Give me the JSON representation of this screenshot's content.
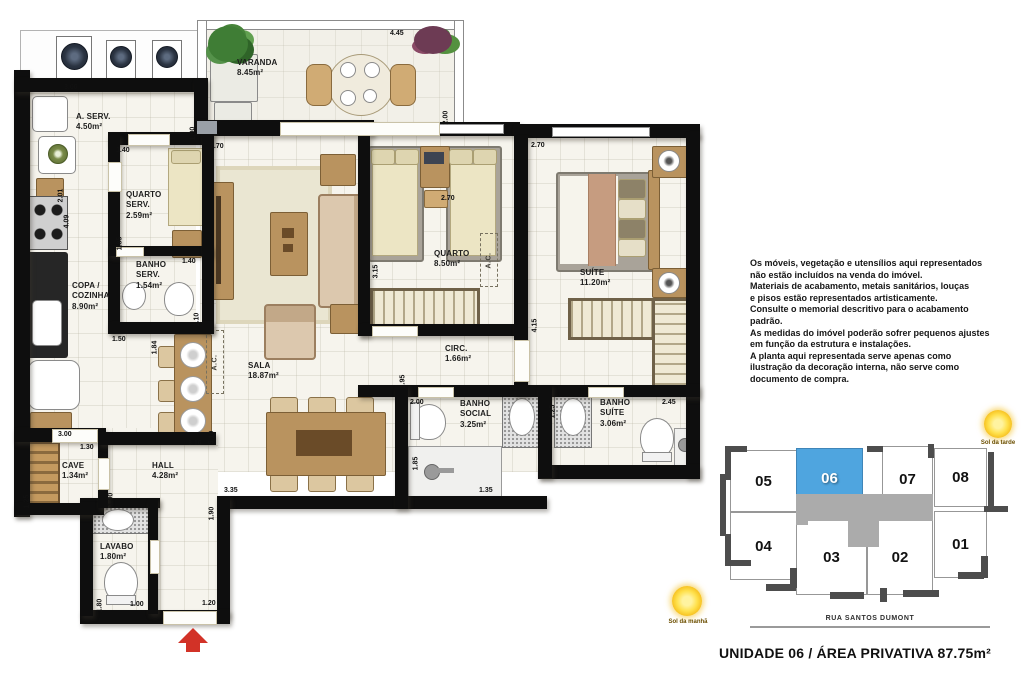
{
  "header": {
    "title": "UNIDADE 06 / ÁREA PRIVATIVA 87.75m²"
  },
  "disclaimer": {
    "lines": [
      "Os móveis, vegetação e utensílios aqui representados",
      "não estão incluídos na venda do imóvel.",
      "Materiais de acabamento, metais sanitários, louças",
      "e pisos estão representados artisticamente.",
      "Consulte o memorial descritivo para o acabamento",
      "padrão.",
      "As medidas do imóvel poderão sofrer pequenos ajustes",
      "em função da estrutura e instalações.",
      "A planta aqui representada serve apenas como",
      "ilustração da decoração interna, não serve como",
      "documento de compra."
    ]
  },
  "plan": {
    "ac_label": "A.C.",
    "rooms": [
      {
        "id": "varanda",
        "name": "VARANDA",
        "area": "8.45m²",
        "x": 237,
        "y": 58
      },
      {
        "id": "a-serv",
        "name": "A. SERV.",
        "area": "4.50m²",
        "x": 76,
        "y": 112
      },
      {
        "id": "quarto-serv",
        "name": "QUARTO\nSERV.",
        "area": "2.59m²",
        "x": 126,
        "y": 190
      },
      {
        "id": "banho-serv",
        "name": "BANHO\nSERV.",
        "area": "1.54m²",
        "x": 136,
        "y": 260
      },
      {
        "id": "copa-cozinha",
        "name": "COPA /\nCOZINHA",
        "area": "8.90m²",
        "x": 72,
        "y": 281
      },
      {
        "id": "sala",
        "name": "SALA",
        "area": "18.87m²",
        "x": 248,
        "y": 361
      },
      {
        "id": "quarto",
        "name": "QUARTO",
        "area": "8.50m²",
        "x": 434,
        "y": 249
      },
      {
        "id": "suite",
        "name": "SUÍTE",
        "area": "11.20m²",
        "x": 580,
        "y": 268
      },
      {
        "id": "circ",
        "name": "CIRC.",
        "area": "1.66m²",
        "x": 445,
        "y": 344
      },
      {
        "id": "banho-social",
        "name": "BANHO\nSOCIAL",
        "area": "3.25m²",
        "x": 460,
        "y": 399
      },
      {
        "id": "banho-suite",
        "name": "BANHO\nSUÍTE",
        "area": "3.06m²",
        "x": 600,
        "y": 398
      },
      {
        "id": "cave",
        "name": "CAVE",
        "area": "1.34m²",
        "x": 62,
        "y": 461
      },
      {
        "id": "hall",
        "name": "HALL",
        "area": "4.28m²",
        "x": 152,
        "y": 461
      },
      {
        "id": "lavabo",
        "name": "LAVABO",
        "area": "1.80m²",
        "x": 100,
        "y": 542
      }
    ],
    "dims": [
      {
        "t": "3.00",
        "x": 64,
        "y": 84
      },
      {
        "t": "1.00",
        "x": 188,
        "y": 120,
        "v": 1
      },
      {
        "t": "4.45",
        "x": 390,
        "y": 30
      },
      {
        "t": "2.00",
        "x": 441,
        "y": 104,
        "v": 1
      },
      {
        "t": "2.70",
        "x": 210,
        "y": 143
      },
      {
        "t": "1.40",
        "x": 116,
        "y": 147
      },
      {
        "t": "1.85",
        "x": 115,
        "y": 230,
        "v": 1
      },
      {
        "t": "2.01",
        "x": 56,
        "y": 182,
        "v": 1
      },
      {
        "t": "4.09",
        "x": 62,
        "y": 208,
        "v": 1
      },
      {
        "t": "1.40",
        "x": 182,
        "y": 258
      },
      {
        "t": "1.10",
        "x": 192,
        "y": 306,
        "v": 1
      },
      {
        "t": "1.50",
        "x": 112,
        "y": 336
      },
      {
        "t": "1.84",
        "x": 150,
        "y": 334,
        "v": 1
      },
      {
        "t": "2.70",
        "x": 441,
        "y": 195
      },
      {
        "t": "3.15",
        "x": 371,
        "y": 258,
        "v": 1
      },
      {
        "t": "2.70",
        "x": 531,
        "y": 142
      },
      {
        "t": "4.15",
        "x": 530,
        "y": 312,
        "v": 1
      },
      {
        "t": "3.00",
        "x": 58,
        "y": 431
      },
      {
        "t": "1.30",
        "x": 80,
        "y": 444
      },
      {
        "t": "1.25",
        "x": 22,
        "y": 488,
        "v": 1
      },
      {
        "t": "1.00",
        "x": 106,
        "y": 486,
        "v": 1
      },
      {
        "t": "3.10",
        "x": 188,
        "y": 440
      },
      {
        "t": "5.10",
        "x": 207,
        "y": 424,
        "v": 1
      },
      {
        "t": "3.35",
        "x": 224,
        "y": 487
      },
      {
        "t": "1.90",
        "x": 207,
        "y": 500,
        "v": 1
      },
      {
        "t": "1.95",
        "x": 398,
        "y": 368,
        "v": 1
      },
      {
        "t": "2.00",
        "x": 410,
        "y": 399
      },
      {
        "t": "1.85",
        "x": 411,
        "y": 450,
        "v": 1
      },
      {
        "t": "1.35",
        "x": 479,
        "y": 487
      },
      {
        "t": "1.25",
        "x": 548,
        "y": 398,
        "v": 1
      },
      {
        "t": "2.45",
        "x": 662,
        "y": 399
      },
      {
        "t": "1.80",
        "x": 95,
        "y": 592,
        "v": 1
      },
      {
        "t": "1.00",
        "x": 130,
        "y": 601
      },
      {
        "t": "1.20",
        "x": 202,
        "y": 600
      }
    ]
  },
  "keyplan": {
    "street": "RUA SANTOS DUMONT",
    "highlight_color": "#4fa5df",
    "units": [
      {
        "n": "05",
        "x": 730,
        "y": 450,
        "w": 67,
        "h": 62
      },
      {
        "n": "06",
        "x": 796,
        "y": 448,
        "w": 67,
        "h": 60,
        "hl": 1
      },
      {
        "n": "07",
        "x": 882,
        "y": 446,
        "w": 51,
        "h": 66
      },
      {
        "n": "08",
        "x": 934,
        "y": 448,
        "w": 53,
        "h": 59
      },
      {
        "n": "04",
        "x": 730,
        "y": 512,
        "w": 67,
        "h": 68
      },
      {
        "n": "03",
        "x": 796,
        "y": 519,
        "w": 71,
        "h": 76
      },
      {
        "n": "02",
        "x": 867,
        "y": 519,
        "w": 66,
        "h": 76
      },
      {
        "n": "01",
        "x": 934,
        "y": 511,
        "w": 53,
        "h": 67
      }
    ]
  },
  "suns": {
    "afternoon": "Sol da tarde",
    "morning": "Sol da manhã"
  }
}
